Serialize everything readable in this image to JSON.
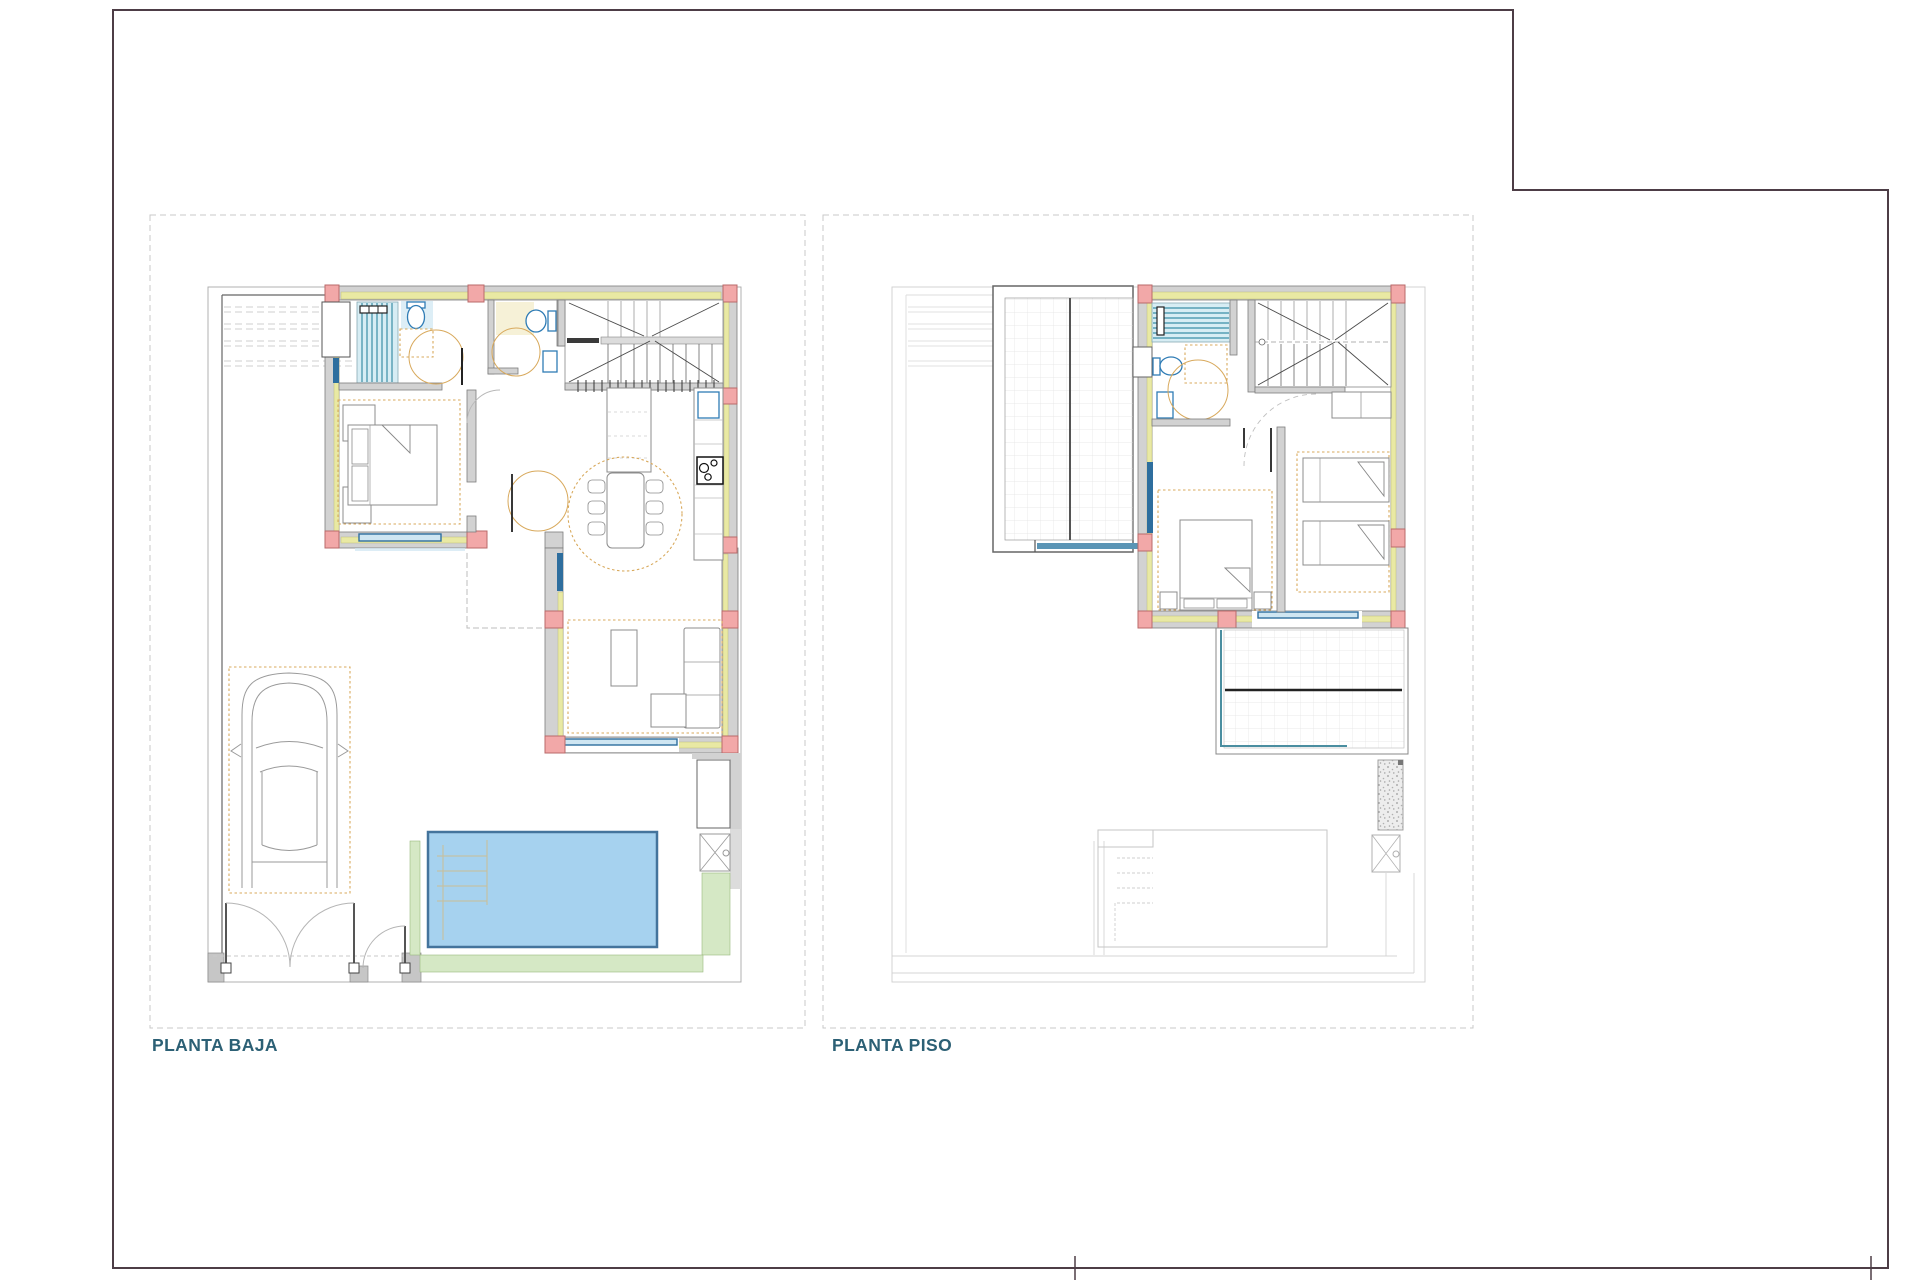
{
  "sheet": {
    "type": "architectural-floor-plan-sheet",
    "background": "#ffffff"
  },
  "floors": [
    {
      "id": "planta-baja",
      "label": "PLANTA BAJA",
      "features": [
        "plot-boundary",
        "carport-roof-lines",
        "double-bedroom",
        "bathroom-with-shower",
        "guest-wc",
        "staircase",
        "kitchen-counter",
        "kitchen-island",
        "stove",
        "dining-table-six-chairs",
        "living-room-sofa",
        "coffee-table",
        "wardrobe",
        "parking-space-with-car",
        "driveway-gate",
        "pedestrian-gate",
        "swimming-pool",
        "pool-steps",
        "lawn-strips",
        "storage-room",
        "skylight-grate",
        "windows"
      ]
    },
    {
      "id": "planta-piso",
      "label": "PLANTA PISO",
      "features": [
        "roof-terrace-tiled",
        "upper-bathroom-with-shower",
        "upper-staircase",
        "landing-closet",
        "double-bedroom",
        "twin-bedroom",
        "rear-terrace-tiled",
        "gravel-strip",
        "skylight-grate",
        "ghost-pool-outline",
        "ghost-plot-lines",
        "windows"
      ]
    }
  ],
  "colors": {
    "sheet_border": "#4d3d46",
    "panel_dash": "#c9c9c9",
    "label_text": "#2c6075",
    "plot_line": "#a8a8a8",
    "wall_fill": "#d2d2d2",
    "wall_stroke": "#7d7d7d",
    "insulation": "#e9e9a3",
    "column_fill": "#f2a8a8",
    "column_stroke": "#b96a6a",
    "window_blue": "#2e6e9e",
    "glazing_light": "#cfe6f2",
    "shower_fill": "#d7edf4",
    "shower_stripe": "#3b8ea6",
    "fixture_blue": "#2f7cb5",
    "tile_blue": "#ddeef6",
    "tile_yellow": "#f6f1d7",
    "furniture_tan": "#d8a95c",
    "furniture_gray": "#8c8c8c",
    "pool_fill": "#a6d2ef",
    "pool_stroke": "#44749c",
    "green_fill": "#d5e8c5",
    "terrace_grid": "#e3e3e3",
    "stair_line": "#4a4a4a",
    "ghost_line": "#c6c6c6",
    "gravel": "#a8a8a8"
  }
}
